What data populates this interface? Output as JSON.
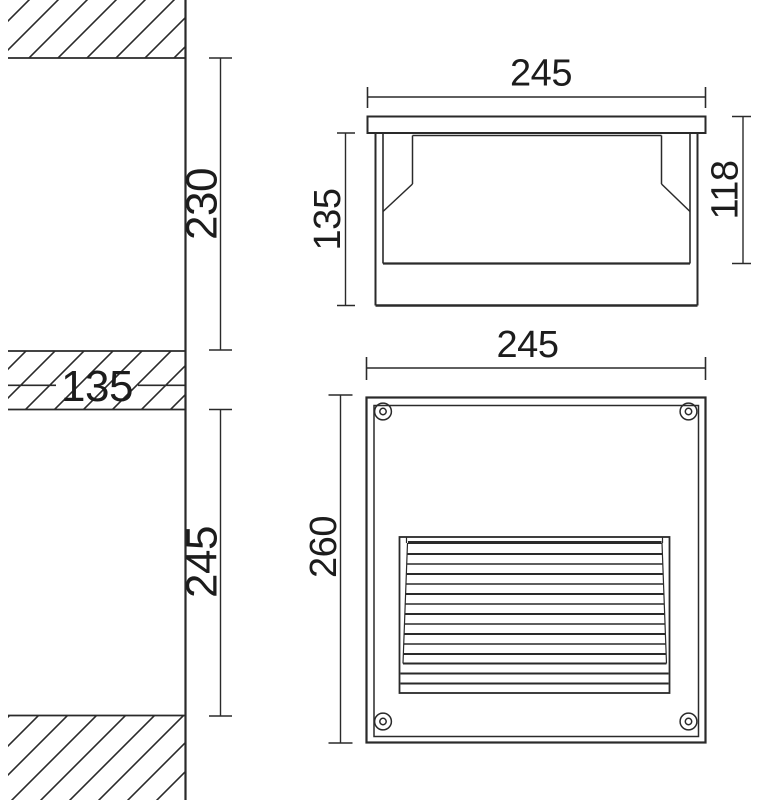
{
  "document": {
    "type": "technical-dimension-drawing",
    "subject": "recessed-wall-light-fixture"
  },
  "colors": {
    "line": "#2a2a2a",
    "text": "#1c1c1c",
    "background": "#ffffff"
  },
  "views": {
    "wall_section": {
      "opening_above": "230",
      "wall_band": "135",
      "opening_below": "245"
    },
    "side_view": {
      "width": "245",
      "body_height": "135",
      "recess_depth": "118"
    },
    "front_view": {
      "width": "245",
      "height": "260"
    }
  }
}
